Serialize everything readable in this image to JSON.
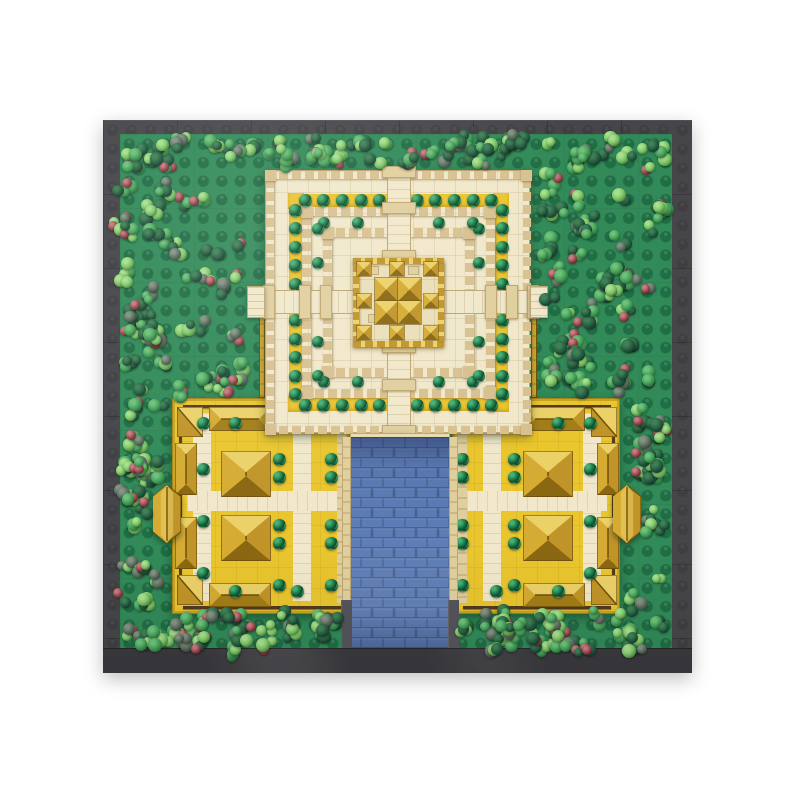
{
  "meta": {
    "title": "Top-down aerial view of a LEGO temple complex MOC: central stepped pyramid with golden spire, two gold-roofed courtyard buildings, blue canal and forested green baseplate",
    "canvas_w": 800,
    "canvas_h": 800,
    "background": "#ffffff"
  },
  "palette": {
    "baseplate": "#46464a",
    "seam": "rgba(0,0,0,0.18)",
    "band": "#3a3a3e",
    "grass": "#318a58",
    "stud": "rgba(6,66,38,0.40)",
    "cream": "#f1e8cb",
    "tan": "#d8c190",
    "tan_dark": "#bda671",
    "tan_block": "#e0cf9e",
    "yellow": "#e9c52e",
    "yellow_dark": "#c9a41f",
    "gold": "#d5ab33",
    "gold_light": "#ecd169",
    "gold_mid": "#c09428",
    "gold_dark": "#a37d18",
    "gold_deep": "#8a6710",
    "gold_outline": "#6e5208",
    "water": "#5b7ab4",
    "water_grout": "#46618f",
    "bush_hi": "#46b075",
    "bush": "#1e7a49",
    "bush_dark": "#0d4226",
    "wall_gray": "#54545a",
    "rail": "#52391f"
  },
  "baseplate": {
    "x": 103,
    "y": 120,
    "w": 589,
    "h": 553,
    "bottom_band": {
      "x": 103,
      "y": 648,
      "w": 589,
      "h": 25
    }
  },
  "grass": {
    "x": 120,
    "y": 134,
    "w": 552,
    "h": 521
  },
  "fences": [
    {
      "x": 259,
      "y": 300,
      "w": 6,
      "h": 98
    },
    {
      "x": 531,
      "y": 300,
      "w": 6,
      "h": 98
    }
  ],
  "pyramid": {
    "x": 265,
    "y": 170,
    "w": 265,
    "h": 263,
    "walls": [
      {
        "inset": 0,
        "t": 8
      },
      {
        "inset": 36,
        "t": 9
      },
      {
        "inset": 57,
        "t": 9
      }
    ],
    "yellow_rings": [
      {
        "inset": 23,
        "t": 13
      }
    ],
    "bush_rings": [
      {
        "inset": 29,
        "size": 13,
        "per_side": [
          0.05,
          0.14,
          0.23,
          0.32,
          0.41,
          0.59,
          0.68,
          0.77,
          0.86,
          0.95
        ]
      },
      {
        "inset": 52,
        "size": 12,
        "per_side": [
          0.04,
          0.25,
          0.75,
          0.96
        ]
      }
    ],
    "path_v": {
      "x": 386,
      "y": 170,
      "w": 24,
      "h": 263
    },
    "path_h": {
      "x": 265,
      "y": 289,
      "w": 265,
      "h": 24
    },
    "gate_blocks_v": [
      165,
      201,
      249,
      340,
      378,
      424
    ],
    "gate_blocks_h": [
      262,
      298,
      319,
      484,
      505,
      526
    ],
    "stubs": [
      {
        "x": 247,
        "y": 286,
        "w": 18,
        "h": 32
      },
      {
        "x": 530,
        "y": 286,
        "w": 18,
        "h": 32
      }
    ],
    "pier": {
      "x": 384,
      "y": 433,
      "w": 27,
      "h": 46
    },
    "gold_center": {
      "x": 352,
      "y": 257,
      "w": 91,
      "h": 89,
      "ring_t": 6,
      "cluster": {
        "x": 374,
        "y": 277,
        "tile": 23,
        "rows": 2,
        "cols": 2
      },
      "small_size": 14,
      "small_pyramids": [
        [
          356,
          261
        ],
        [
          423,
          261
        ],
        [
          356,
          325
        ],
        [
          423,
          325
        ],
        [
          389,
          261
        ],
        [
          389,
          325
        ],
        [
          356,
          293
        ],
        [
          423,
          293
        ]
      ],
      "tan_blocks": [
        [
          368,
          266
        ],
        [
          408,
          266
        ],
        [
          368,
          314
        ],
        [
          408,
          314
        ]
      ]
    }
  },
  "water": {
    "x": 350,
    "y": 437,
    "w": 100,
    "h": 211,
    "lip": {
      "x": 350,
      "y": 433,
      "w": 100,
      "h": 5
    },
    "edges": [
      {
        "x": 342,
        "y": 437,
        "w": 9,
        "h": 163
      },
      {
        "x": 449,
        "y": 437,
        "w": 9,
        "h": 163
      }
    ],
    "walls": [
      {
        "x": 341,
        "y": 600,
        "w": 11,
        "h": 48
      },
      {
        "x": 448,
        "y": 600,
        "w": 11,
        "h": 48
      }
    ],
    "brick": {
      "bw": 22,
      "bh": 10
    }
  },
  "buildings": [
    {
      "name": "west-courtyard-building",
      "x": 172,
      "y": 398,
      "w": 178,
      "h": 216,
      "mirror": false
    },
    {
      "name": "east-courtyard-building",
      "x": 452,
      "y": 398,
      "w": 168,
      "h": 216,
      "mirror": true
    }
  ],
  "building_layout": {
    "paths_v": [
      {
        "x": 20,
        "y": 14,
        "w": 18,
        "h": 188
      },
      {
        "x": 120,
        "y": 14,
        "w": 18,
        "h": 188
      }
    ],
    "path_h": {
      "x": 14,
      "y": 92,
      "h": 20
    },
    "waterside_walk_w": 9,
    "rails": {
      "top": 6,
      "bottom": 9,
      "side": 6,
      "t": 3
    },
    "roofs": [
      {
        "type": "h",
        "x": 36,
        "y": 8,
        "w": 62,
        "h": 24
      },
      {
        "type": "h",
        "x": 36,
        "yb": 32,
        "w": 62,
        "h": 24
      },
      {
        "type": "corner",
        "x": 4,
        "y": 8,
        "w": 26,
        "h": 30
      },
      {
        "type": "corner",
        "x": 4,
        "yb": 40,
        "w": 26,
        "h": 30
      },
      {
        "type": "v",
        "x": 2,
        "y": 44,
        "w": 22,
        "h": 52
      },
      {
        "type": "v",
        "x": 2,
        "yb": 98,
        "w": 22,
        "h": 52
      }
    ],
    "halls": [
      {
        "x": 48,
        "y": 52,
        "w": 50,
        "h": 46
      },
      {
        "x": 48,
        "y": 116,
        "w": 50,
        "h": 46
      }
    ],
    "bushes": [
      [
        100,
        54
      ],
      [
        100,
        72
      ],
      [
        100,
        120
      ],
      [
        100,
        138
      ],
      [
        100,
        180
      ],
      [
        152,
        54
      ],
      [
        152,
        72
      ],
      [
        152,
        120
      ],
      [
        152,
        138
      ],
      [
        152,
        180
      ],
      [
        24,
        64
      ],
      [
        24,
        116
      ],
      [
        24,
        168
      ],
      [
        56,
        18
      ],
      [
        56,
        186
      ],
      [
        118,
        18
      ],
      [
        24,
        18
      ],
      [
        118,
        186
      ]
    ],
    "bush_size": 13,
    "gate": {
      "dx": -20,
      "y": 86,
      "w": 28,
      "h": 58
    }
  },
  "trees": {
    "seed": 20240901,
    "cluster_florets_min": 2,
    "cluster_florets_max": 5,
    "floret_min": 9,
    "floret_max": 14,
    "regions": [
      {
        "x": 118,
        "y": 132,
        "w": 556,
        "h": 40,
        "count": 48
      },
      {
        "x": 114,
        "y": 172,
        "w": 132,
        "h": 226,
        "count": 46
      },
      {
        "x": 538,
        "y": 172,
        "w": 132,
        "h": 226,
        "count": 44
      },
      {
        "x": 112,
        "y": 398,
        "w": 58,
        "h": 214,
        "count": 24
      },
      {
        "x": 622,
        "y": 398,
        "w": 48,
        "h": 214,
        "count": 22
      },
      {
        "x": 118,
        "y": 610,
        "w": 222,
        "h": 46,
        "count": 30
      },
      {
        "x": 458,
        "y": 610,
        "w": 212,
        "h": 46,
        "count": 30
      }
    ],
    "avoid": [
      [
        246,
        282,
        22,
        40
      ],
      [
        528,
        282,
        22,
        40
      ],
      [
        152,
        480,
        34,
        64
      ],
      [
        608,
        480,
        34,
        64
      ],
      [
        339,
        596,
        16,
        54
      ],
      [
        446,
        596,
        16,
        54
      ]
    ],
    "palette": [
      {
        "name": "light-green",
        "base": "#7cc568",
        "hi": "#a8e08e",
        "dark": "#447f35",
        "w": 0.24
      },
      {
        "name": "mid-green",
        "base": "#46a159",
        "hi": "#6fc17b",
        "dark": "#256b36",
        "w": 0.27
      },
      {
        "name": "dark-green",
        "base": "#275f41",
        "hi": "#3f8157",
        "dark": "#12352a",
        "w": 0.29
      },
      {
        "name": "sage",
        "base": "#5d6f60",
        "hi": "#839483",
        "dark": "#36443a",
        "w": 0.11
      },
      {
        "name": "red-berry",
        "base": "#9a4950",
        "hi": "#c47d80",
        "dark": "#5c2026",
        "w": 0.09
      }
    ]
  }
}
